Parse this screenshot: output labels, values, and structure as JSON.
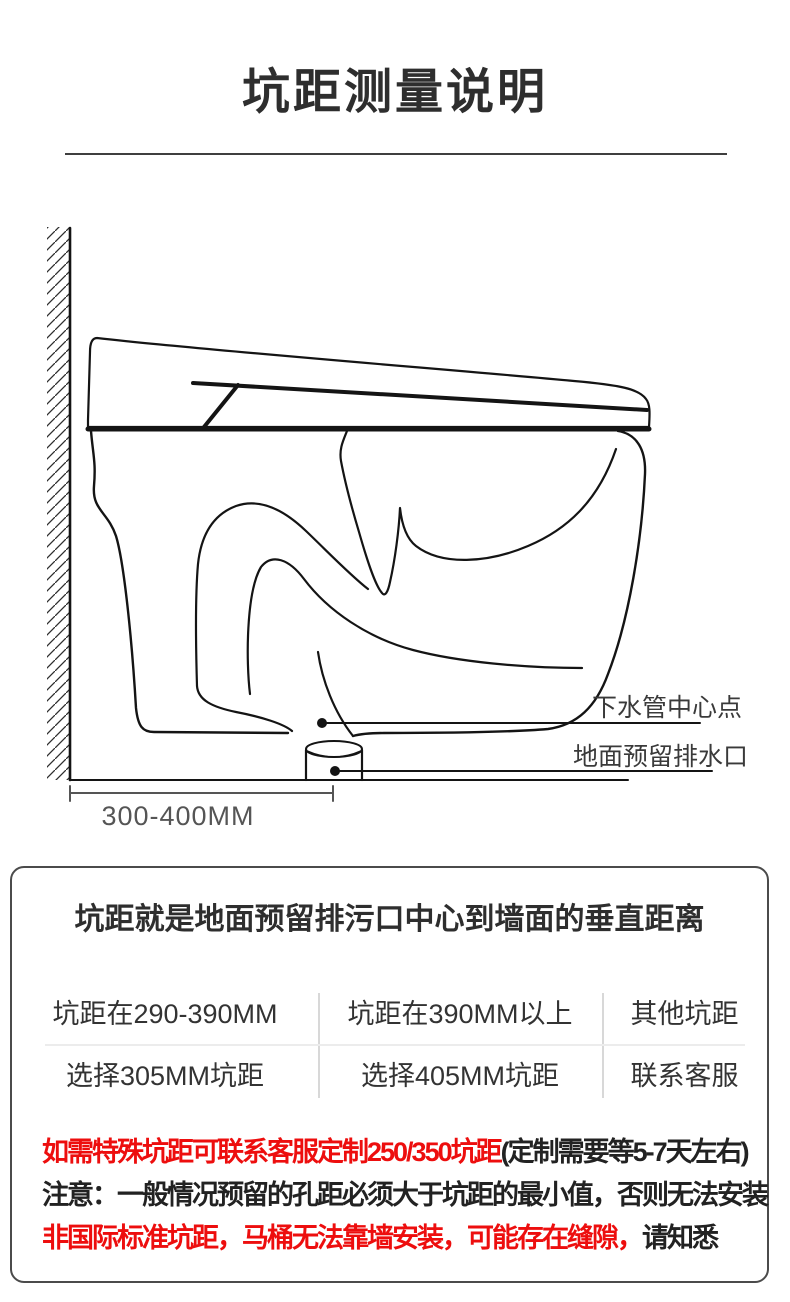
{
  "title": {
    "text": "坑距测量说明"
  },
  "diagram": {
    "labels": {
      "drain_center": "下水管中心点",
      "floor_outlet": "地面预留排水口",
      "dimension": "300-400MM"
    }
  },
  "info_box": {
    "headline": "坑距就是地面预留排污口中心到墙面的垂直距离",
    "table": {
      "columns": [
        {
          "condition": "坑距在290-390MM",
          "action": "选择305MM坑距"
        },
        {
          "condition": "坑距在390MM以上",
          "action": "选择405MM坑距"
        },
        {
          "condition": "其他坑距",
          "action": "联系客服"
        }
      ]
    },
    "notes": [
      {
        "segments": [
          {
            "text": "如需特殊坑距可联系客服定制250/350坑距",
            "color": "red"
          },
          {
            "text": "(定制需要等5-7天左右)",
            "color": "black"
          }
        ]
      },
      {
        "segments": [
          {
            "text": "注意：一般情况预留的孔距必须大于坑距的最小值，否则无法安装",
            "color": "black"
          }
        ]
      },
      {
        "segments": [
          {
            "text": "非国际标准坑距，马桶无法靠墙安装，可能存在缝隙，",
            "color": "red"
          },
          {
            "text": "请知悉",
            "color": "black"
          }
        ]
      }
    ]
  },
  "colors": {
    "red": "#ed0e0e",
    "ink": "#141414",
    "text_dark": "#2e2e2e",
    "label": "#3a3a3a",
    "dim": "#555555",
    "border": "#4b4b4b",
    "divider": "#d8d8d8",
    "row_divider": "#ececec",
    "rule": "#3f3f3f"
  }
}
